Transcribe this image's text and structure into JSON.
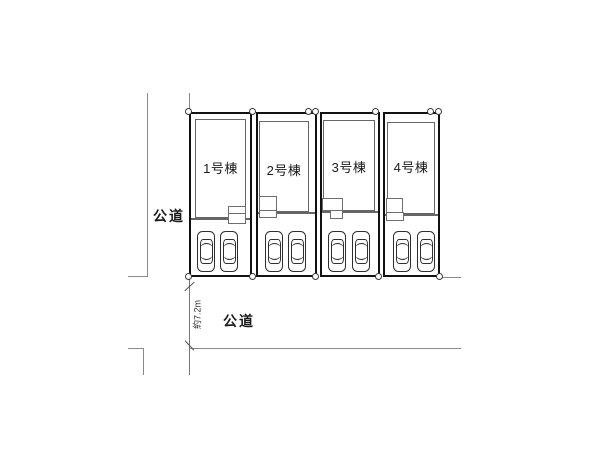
{
  "plan": {
    "type": "real-estate-site-plan",
    "lots": [
      {
        "label": "1号棟",
        "cars": 2
      },
      {
        "label": "2号棟",
        "cars": 2
      },
      {
        "label": "3号棟",
        "cars": 2
      },
      {
        "label": "4号棟",
        "cars": 2
      }
    ],
    "road_left": {
      "label": "公道"
    },
    "road_bottom": {
      "label": "公道"
    },
    "dimension": {
      "label": "約7.2m"
    }
  },
  "colors": {
    "background": "#ffffff",
    "lot_border": "#111111",
    "building_outline": "#666666",
    "road_line": "#8a8a8a",
    "text": "#1a1a1a"
  }
}
